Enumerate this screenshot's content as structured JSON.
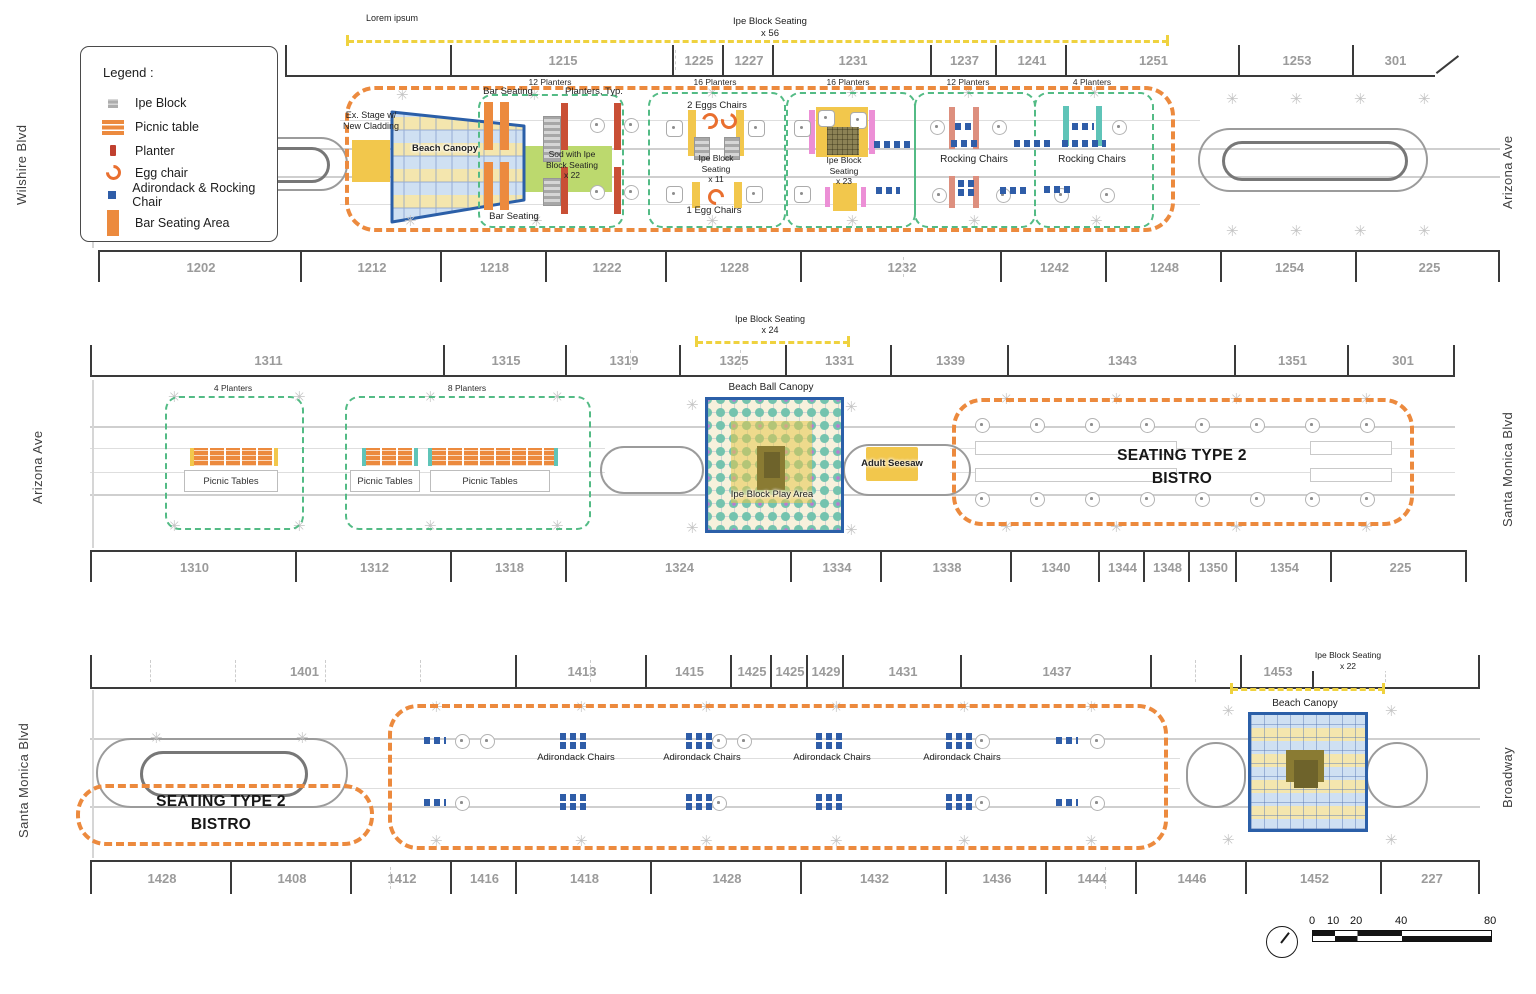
{
  "icons": {
    "tree": "✳"
  },
  "colors": {
    "zone_orange": "#EC8A3E",
    "zone_green": "#53BB85",
    "dim_yellow": "#EFD23F",
    "canopy_blue": "#2B5FA8",
    "chair_blue": "#2F5DA8",
    "planter_red": "#C0402F",
    "planter_pink": "#EC8FD6",
    "planter_teal": "#5FC4B8",
    "sod_green": "#BCD96E",
    "yellow_fill": "#F2C74C",
    "ipe_gray": "#ADADAD"
  },
  "legend": {
    "title": "Legend :",
    "items": [
      {
        "label": "Ipe Block"
      },
      {
        "label": "Picnic table"
      },
      {
        "label": "Planter"
      },
      {
        "label": "Egg chair"
      },
      {
        "label": "Adirondack & Rocking Chair"
      },
      {
        "label": "Bar Seating Area"
      }
    ]
  },
  "row1": {
    "street_left": "Wilshire Blvd",
    "street_right": "Arizona Ave",
    "note": "Lorem ipsum",
    "dim": "Ipe Block Seating\nx 56",
    "top_addresses": [
      "",
      "1215",
      "1225",
      "1227",
      "1231",
      "1237",
      "1241",
      "1251",
      "1253",
      "301"
    ],
    "planter_counts": [
      "12 Planters",
      "16 Planters",
      "16 Planters",
      "12 Planters",
      "4 Planters"
    ],
    "labels": {
      "stage": "Ex. Stage w/\nNew Cladding",
      "beach_canopy": "Beach Canopy",
      "bar_seating_top": "Bar Seating",
      "bar_seating_bottom": "Bar Seating",
      "planters_typ": "Planters, Typ.",
      "sod": "Sod with Ipe\nBlock Seating\nx 22",
      "eggs2": "2 Eggs Chairs",
      "ipe11": "Ipe Block\nSeating\nx 11",
      "egg1": "1 Egg Chairs",
      "ipe23": "Ipe Block\nSeating\nx 23",
      "rocking1": "Rocking Chairs",
      "rocking2": "Rocking Chairs"
    },
    "bottom_addresses": [
      "1202",
      "1212",
      "1218",
      "1222",
      "1228",
      "1232",
      "1242",
      "1248",
      "1254",
      "225"
    ]
  },
  "row2": {
    "street_left": "Arizona Ave",
    "street_right": "Santa Monica Blvd",
    "dim": "Ipe Block Seating\nx 24",
    "top_addresses": [
      "1311",
      "1315",
      "1319",
      "1325",
      "1331",
      "1339",
      "1343",
      "1351",
      "301"
    ],
    "labels": {
      "p4": "4 Planters",
      "p8": "8 Planters",
      "picnic1": "Picnic Tables",
      "picnic2": "Picnic Tables",
      "picnic3": "Picnic Tables",
      "ball_canopy": "Beach Ball Canopy",
      "play_area": "Ipe Block Play Area",
      "seesaw": "Adult Seesaw",
      "bistro": "SEATING TYPE 2\nBISTRO"
    },
    "bottom_addresses": [
      "1310",
      "1312",
      "1318",
      "1324",
      "1334",
      "1338",
      "1340",
      "1344",
      "1348",
      "1350",
      "1354",
      "225"
    ]
  },
  "row3": {
    "street_left": "Santa Monica Blvd",
    "street_right": "Broadway",
    "dim": "Ipe Block Seating\nx 22",
    "top_addresses": [
      "1401",
      "1413",
      "1415",
      "1425",
      "1425",
      "1429",
      "1431",
      "1437",
      "",
      "1453",
      ""
    ],
    "labels": {
      "bistro": "SEATING TYPE 2\nBISTRO",
      "adirondack1": "Adirondack Chairs",
      "adirondack2": "Adirondack Chairs",
      "adirondack3": "Adirondack Chairs",
      "adirondack4": "Adirondack Chairs",
      "beach_canopy": "Beach Canopy"
    },
    "bottom_addresses": [
      "1428",
      "1408",
      "1412",
      "1416",
      "1418",
      "1428",
      "1432",
      "1436",
      "1444",
      "1446",
      "1452",
      "227"
    ]
  },
  "scale": {
    "ticks": [
      "0",
      "10",
      "20",
      "40",
      "80"
    ]
  }
}
